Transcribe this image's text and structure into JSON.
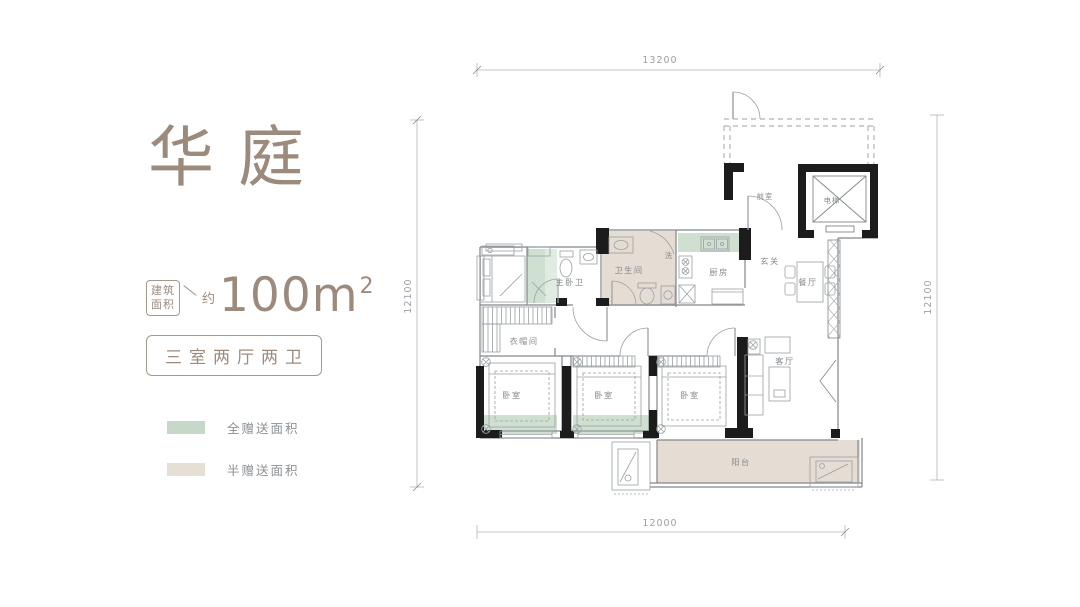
{
  "panel": {
    "title": "华庭",
    "area_badge_line1": "建筑",
    "area_badge_line2": "面积",
    "area_approx": "约",
    "area_value": "100m",
    "area_sup": "2",
    "layout_text": "三室两厅两卫",
    "legend": [
      {
        "label": "全赠送面积",
        "color": "#c6d9c9"
      },
      {
        "label": "半赠送面积",
        "color": "#e6dfd5"
      }
    ]
  },
  "dimensions": {
    "top": "13200",
    "left": "12100",
    "right": "12100",
    "bottom": "12000"
  },
  "rooms": {
    "vestibule": "前室",
    "elevator": "电梯",
    "foyer": "玄关",
    "dining": "餐厅",
    "kitchen": "厨房",
    "bathroom": "卫生间",
    "master_bath": "主卧卫",
    "wash": "洗",
    "closet": "衣帽间",
    "bedroom1": "卧室",
    "bedroom2": "卧室",
    "bedroom3": "卧室",
    "living": "客厅",
    "balcony": "阳台"
  },
  "colors": {
    "brand": "#9c8a7d",
    "plan_green": "#cfe0d1",
    "plan_green_light": "#e0ebe1",
    "plan_beige": "#e5ddd3",
    "wall_black": "#1c1c1c",
    "line_gray": "#8e9497"
  }
}
